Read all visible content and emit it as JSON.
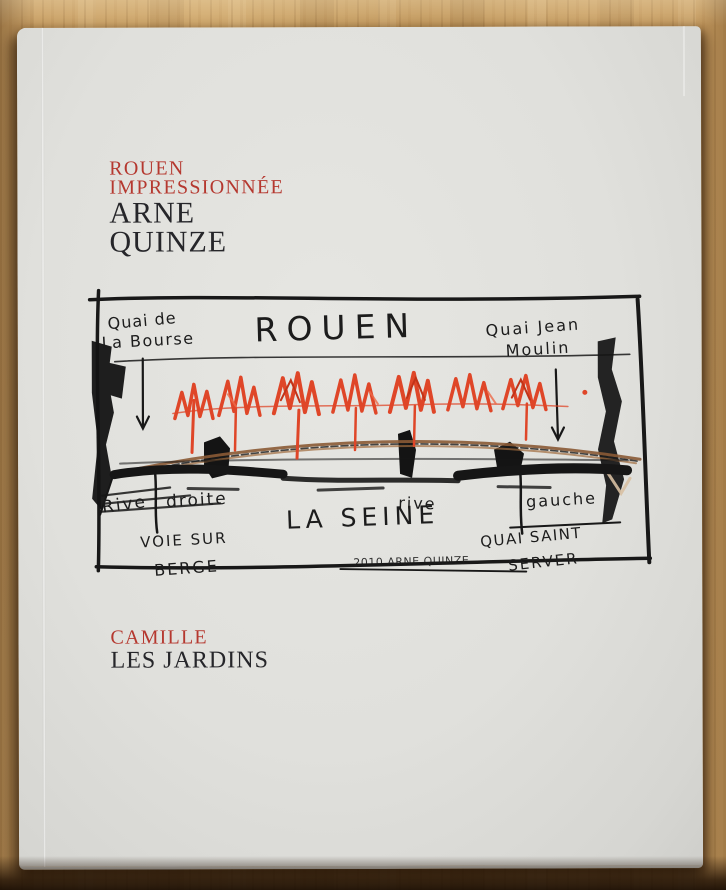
{
  "cover": {
    "title_line1": "ROUEN",
    "title_line2": "IMPRESSIONNÉE",
    "author_line1": "ARNE",
    "author_line2": "QUINZE",
    "footer_line1": "CAMILLE",
    "footer_line2": "LES JARDINS"
  },
  "sketch": {
    "title": "ROUEN",
    "river_label": "LA SEINE",
    "quai_bourse_line1": "Quai de",
    "quai_bourse_line2": "La Bourse",
    "quai_moulin_line1": "Quai Jean",
    "quai_moulin_line2": "Moulin",
    "rive_droite_a": "Rive",
    "rive_droite_b": "droite",
    "voie_sur_line1": "VOIE SUR",
    "voie_sur_line2": "BERGE",
    "rive_gauche_a": "rive",
    "rive_gauche_b": "gauche",
    "quai_sever_line1": "QUAI SAINT",
    "quai_sever_line2": "SERVER",
    "signature": "2010 ARNE QUINZE"
  },
  "colors": {
    "wood": "#c79d62",
    "cover_paper": "#e3e3df",
    "title_red": "#b5382f",
    "text_black": "#26262a",
    "sketch_ink": "#1b1b1b",
    "flame_red": "#df4628",
    "bridge_brown": "#8a5a35"
  }
}
